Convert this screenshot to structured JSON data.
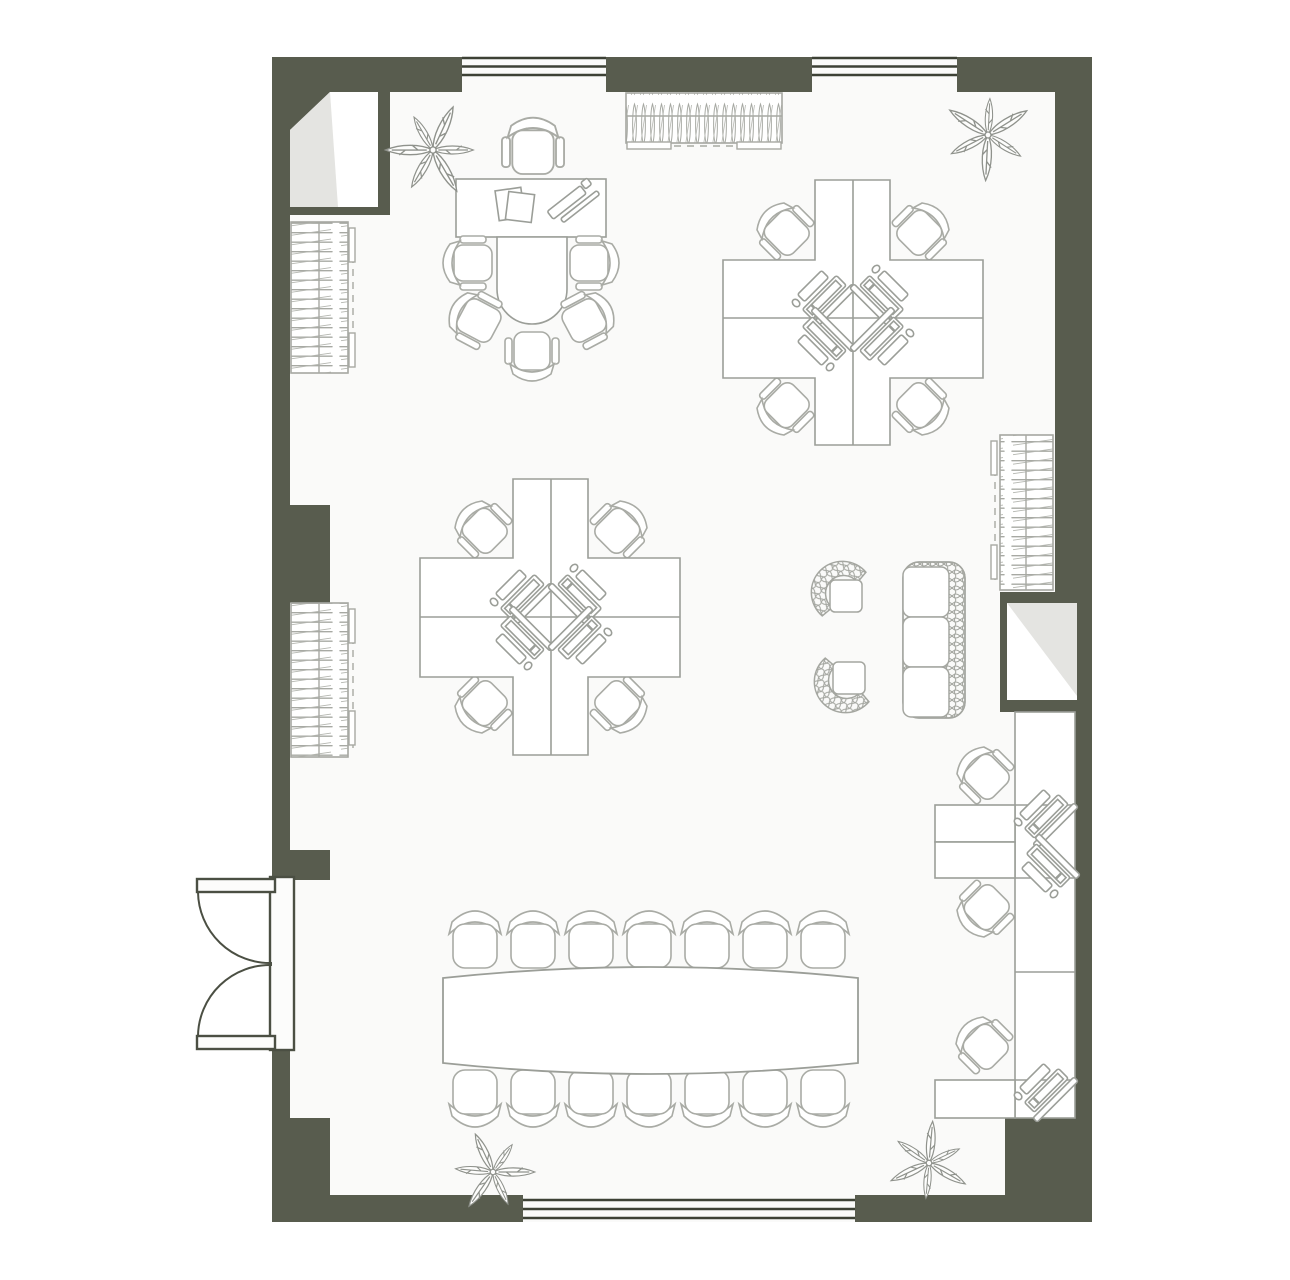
{
  "meta": {
    "title": "Office floor plan",
    "description": "Top-down architectural floor plan of a rectangular office with olive-gray walls, three window bands, a double entry door, two quad workstation clusters, an executive desk with meeting extension, a 14-seat conference table, wall-mounted workstations, a wicker lounge set, radiators, a coat rack and four plants.",
    "canvas": {
      "width": 1290,
      "height": 1280
    }
  },
  "palette": {
    "outside": "#ffffff",
    "floor": "#fafaf9",
    "wall": "#585c4e",
    "window_line": "#3d4135",
    "door_line": "#4b4f43",
    "desk_line": "#9b9e98",
    "chair_line": "#a9aba5",
    "wicker_line": "#a4a6a0",
    "plant_line": "#8f928c",
    "radiator_line": "#a7a9a3",
    "fold_shade": "#e4e4e1",
    "leaf_fill": "#fdfdfc"
  },
  "structure": {
    "windows": [
      {
        "name": "top-window-left",
        "edge": "top",
        "x1": 462,
        "x2": 606
      },
      {
        "name": "top-window-right",
        "edge": "top",
        "x1": 812,
        "x2": 957
      },
      {
        "name": "bottom-window",
        "edge": "bottom",
        "x1": 523,
        "x2": 855
      }
    ],
    "door": {
      "name": "entry-double-door",
      "edge": "left",
      "y1": 880,
      "y2": 1048,
      "leaves": 2,
      "swing": "outward"
    },
    "shafts": [
      {
        "name": "shaft-top-left",
        "x": 290,
        "y": 92,
        "w": 88,
        "h": 115
      },
      {
        "name": "shaft-right",
        "x": 1007,
        "y": 603,
        "w": 70,
        "h": 97
      }
    ]
  },
  "furniture": {
    "executive_area": {
      "desk": {
        "x": 456,
        "y": 179,
        "w": 150,
        "h": 58
      },
      "meeting_extension": "rounded peninsula below desk",
      "executive_chair_count": 1,
      "visitor_chair_count": 5,
      "desk_items": [
        "papers",
        "pen-tray",
        "ruler"
      ]
    },
    "workstation_clusters": [
      {
        "name": "cluster-top-right",
        "center": {
          "x": 853,
          "y": 318
        },
        "desks": 4,
        "chairs": 4,
        "monitors": 4
      },
      {
        "name": "cluster-mid-left",
        "center": {
          "x": 551,
          "y": 617
        },
        "desks": 4,
        "chairs": 4,
        "monitors": 4
      }
    ],
    "wall_workstations": {
      "desks": 3,
      "chairs": 3,
      "monitors": 3,
      "location": "along right wall"
    },
    "conference": {
      "table": "boat-shaped",
      "x": 443,
      "y": 956,
      "w": 415,
      "chairs_top": 7,
      "chairs_bottom": 7
    },
    "lounge": {
      "armchairs": 2,
      "sofa_seats": 3,
      "style": "wicker"
    },
    "fixtures": {
      "radiators": [
        {
          "name": "radiator-left-upper",
          "x": 291,
          "y": 222
        },
        {
          "name": "radiator-left-lower",
          "x": 291,
          "y": 603
        },
        {
          "name": "radiator-right",
          "x": 1000,
          "y": 435
        }
      ],
      "coat_rack": {
        "x": 626,
        "y": 93,
        "w": 156,
        "h": 50
      },
      "plants": [
        {
          "name": "plant-top-left",
          "x": 433,
          "y": 150
        },
        {
          "name": "plant-top-right",
          "x": 988,
          "y": 135
        },
        {
          "name": "plant-bottom-left",
          "x": 493,
          "y": 1172
        },
        {
          "name": "plant-bottom-right",
          "x": 929,
          "y": 1163
        }
      ]
    }
  }
}
